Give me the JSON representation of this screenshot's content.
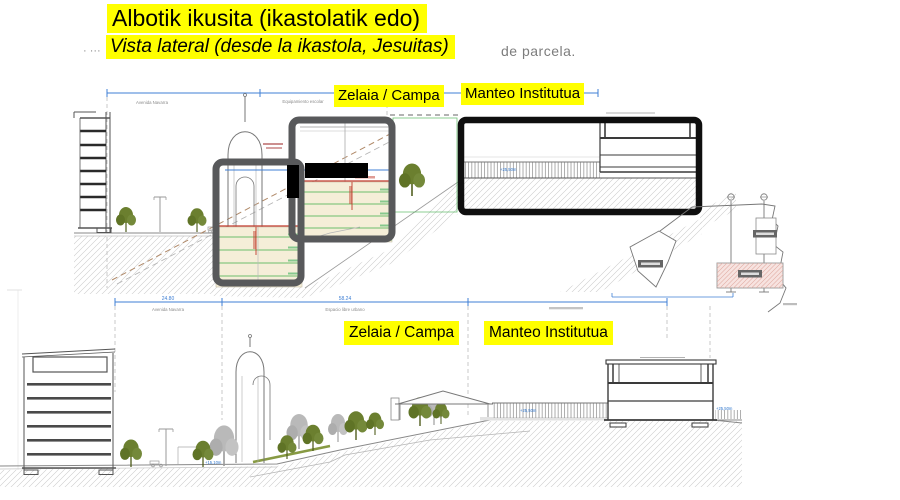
{
  "slide": {
    "title": "Albotik ikusita (ikastolatik edo)",
    "subtitle": "Vista lateral (desde la ikastola, Jesuitas)",
    "covered_left": "· ···",
    "covered_right": "de parcela.",
    "highlight_color": "#ffff00"
  },
  "labels": {
    "top_field": "Zelaia / Campa",
    "top_school": "Manteo Institutua",
    "bottom_field": "Zelaia / Campa",
    "bottom_school": "Manteo Institutua"
  },
  "top_drawing": {
    "caption_street": "Avenida Navarra",
    "caption_zone": "Equipamiento escolar",
    "level_fence": "+25,50m",
    "level_street": "+15,10m"
  },
  "bottom_drawing": {
    "dim_left": "24.80",
    "dim_mid": "58.24",
    "caption_street": "Avenida Navarra",
    "caption_zone": "Espacio libre urbano",
    "level_street": "+15,10m",
    "level_plateau_left": "+25,50m",
    "level_plateau_right": "+25,50m"
  },
  "colors": {
    "highlight": "#ffff00",
    "dimension_blue": "#3f7fd4",
    "level_blue": "#2e75cc",
    "frame_gray": "#58595b",
    "frame_black": "#0f0f0f",
    "tree_olive": "#6b7f2f",
    "tree_gray": "#b3b3b3",
    "section_cream": "#f5eed8",
    "level_green": "#3fae49",
    "accent_red": "#c0392b",
    "plan_pink": "#f7e3e0"
  }
}
